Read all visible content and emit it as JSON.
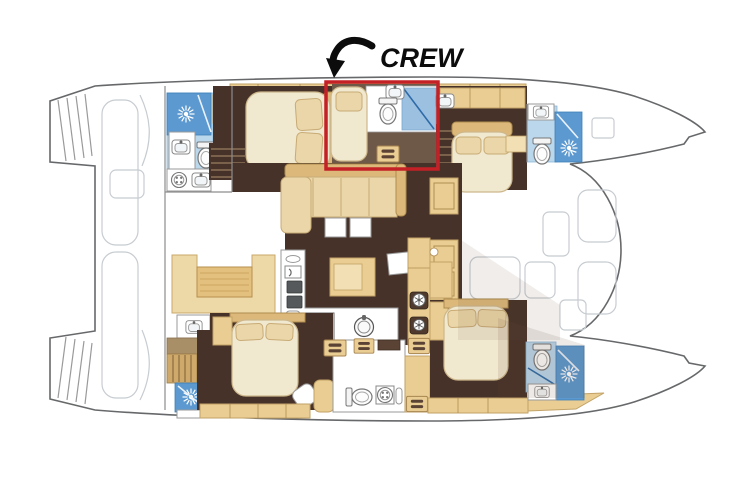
{
  "annotation": {
    "label": "CREW",
    "arrow_icon": "curved-arrow-down-left"
  },
  "highlight": {
    "color": "#c42127",
    "stroke_width": 3.5,
    "x": 326,
    "y": 82,
    "width": 112,
    "height": 87,
    "region": "crew-cabin-and-head"
  },
  "palette": {
    "hull_outline": "#66686a",
    "deck_faint": "#c7ccd1",
    "floor_dark_wood": "#463228",
    "floor_brown": "#6e5847",
    "furniture_tan": "#e9cd93",
    "furniture_tan_dark": "#dcb97a",
    "mattress_cream": "#f1e8d0",
    "bath_floor_light_blue": "#bad7ec",
    "shower_blue": "#5c99d0",
    "highlight_red": "#c42127"
  },
  "icons": {
    "shower": "sunburst-rays",
    "toilet": "oval-bowl-with-tank",
    "sink": "basin-with-faucet",
    "washing_machine": "circle-drum",
    "stove": "four-burner-hob",
    "round_sink": "double-circle",
    "lockers": "slotted-drawer",
    "annotation_arrow": "curved-arrow-down-left"
  }
}
